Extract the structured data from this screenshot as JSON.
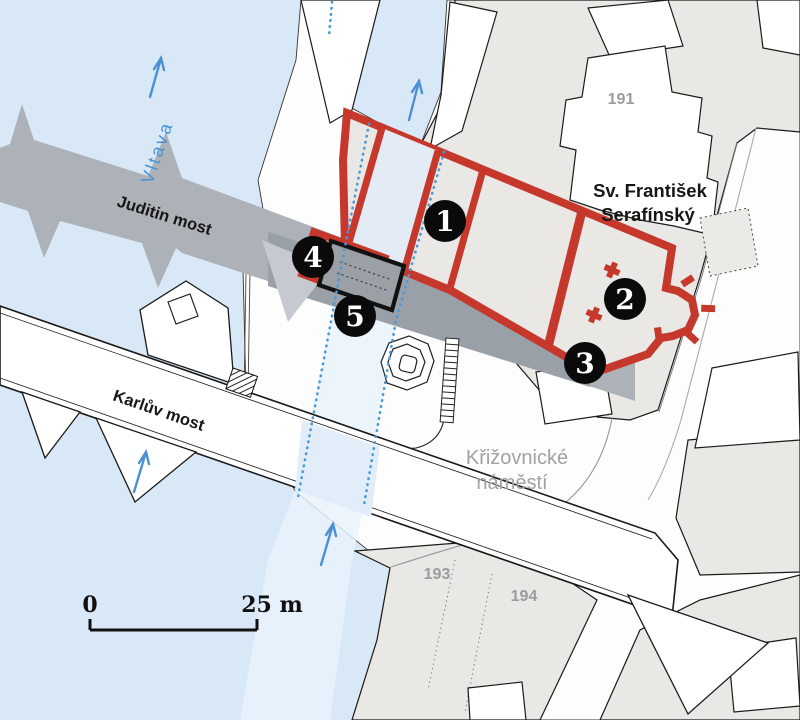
{
  "map": {
    "labels": {
      "river": "Vltava",
      "judith_bridge": "Juditin most",
      "charles_bridge": "Karlův most",
      "church_line1": "Sv. František",
      "church_line2": "Serafínský",
      "square_line1": "Křižovnické",
      "square_line2": "náměstí"
    },
    "parcels": [
      "191",
      "193",
      "194"
    ],
    "markers": [
      "1",
      "2",
      "3",
      "4",
      "5"
    ],
    "scale": {
      "start": "0",
      "end": "25 m"
    },
    "colors": {
      "water": "#d9e8f7",
      "corridor_highlight": "#e9f2fb",
      "land_block": "#e9e8e5",
      "building_fill": "#ffffff",
      "outline": "#1a1a1a",
      "excavation_red": "#c7382c",
      "judith_band_gray": "#adb2b8",
      "flow_arrow_blue": "#4a90d4",
      "label_gray": "#9c9c9c"
    }
  }
}
